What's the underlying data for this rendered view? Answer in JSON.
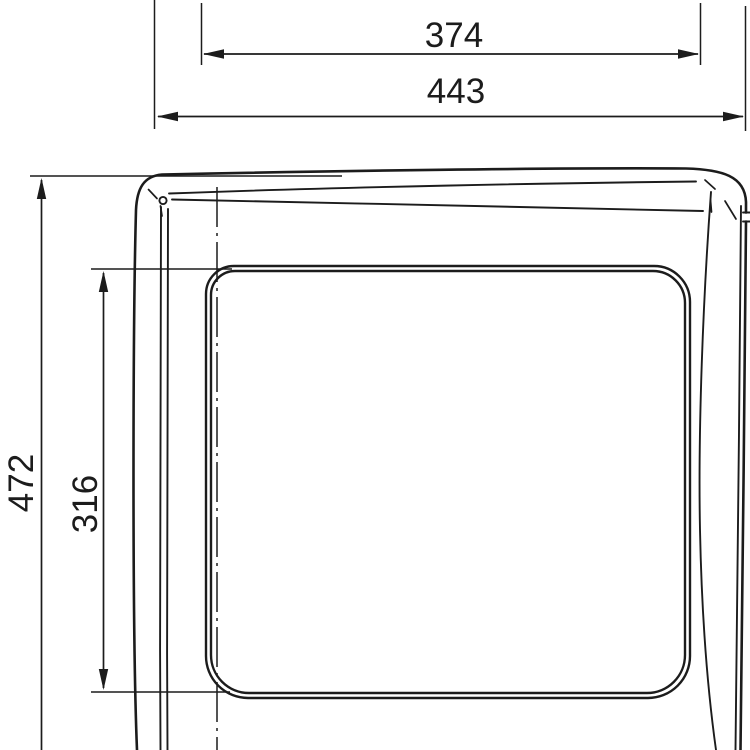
{
  "drawing": {
    "type": "technical-dimension-drawing",
    "line_color": "#1c1c1c",
    "background_color": "#ffffff",
    "dimensions": {
      "width_inner": {
        "label": "374"
      },
      "width_overall": {
        "label": "443"
      },
      "height_overall": {
        "label": "472"
      },
      "height_inner": {
        "label": "316"
      }
    }
  }
}
